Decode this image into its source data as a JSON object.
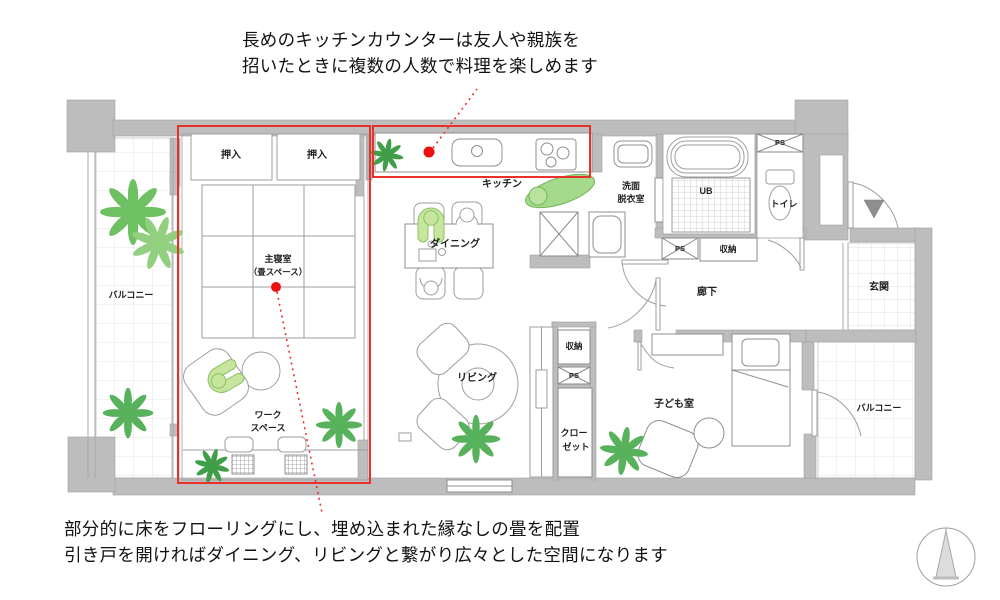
{
  "annotations": {
    "top_line1": "長めのキッチンカウンターは友人や親族を",
    "top_line2": "招いたときに複数の人数で料理を楽しめます",
    "bottom_line1": "部分的に床をフローリングにし、埋め込まれた縁なしの畳を配置",
    "bottom_line2": "引き戸を開ければダイニング、リビングと繋がり広々とした空間になります"
  },
  "labels": {
    "oshiire_left": "押入",
    "oshiire_right": "押入",
    "main_bedroom": "主寝室",
    "main_bedroom_sub": "（畳スペース）",
    "balcony_left": "バルコニー",
    "kitchen": "キッチン",
    "dining": "ダイニング",
    "washroom_1": "洗面",
    "washroom_2": "脱衣室",
    "ub": "UB",
    "toilet": "トイレ",
    "ps_top": "PS",
    "ps_hall": "PS",
    "ps_center": "PS",
    "storage_hall": "収納",
    "storage_center": "収納",
    "hallway": "廊下",
    "entrance": "玄関",
    "closet_1": "クロー",
    "closet_2": "ゼット",
    "living": "リビング",
    "kids_room": "子ども室",
    "balcony_right": "バルコニー",
    "workspace_1": "ワーク",
    "workspace_2": "スペース"
  },
  "colors": {
    "highlight_red": "#e8312a",
    "wall_gray": "#bdbdbd",
    "plant_green": "#58b25c"
  }
}
